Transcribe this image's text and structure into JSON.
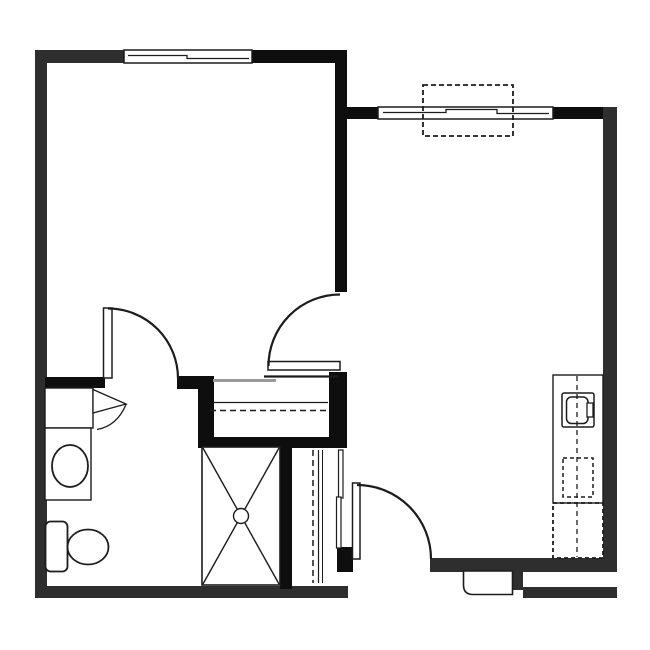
{
  "canvas": {
    "width": 650,
    "height": 650,
    "background": "#ffffff"
  },
  "colors": {
    "wall": "#2e2e2e",
    "wall_dark": "#0e0e0e",
    "line": "#1c1c1c",
    "track": "#9a9a9a",
    "white": "#ffffff"
  },
  "shapes": [
    {
      "type": "rect",
      "name": "top-wall-left",
      "x": 35,
      "y": 50,
      "w": 90,
      "h": 13,
      "fill": "wall"
    },
    {
      "type": "rect",
      "name": "top-wall-mid",
      "x": 252,
      "y": 50,
      "w": 95,
      "h": 13,
      "fill": "wall_dark"
    },
    {
      "type": "rect",
      "name": "left-wall",
      "x": 35,
      "y": 50,
      "w": 12,
      "h": 548,
      "fill": "wall"
    },
    {
      "type": "rect",
      "name": "bottom-wall-left",
      "x": 35,
      "y": 586,
      "w": 313,
      "h": 12,
      "fill": "wall"
    },
    {
      "type": "rect",
      "name": "bedroom-living-wall",
      "x": 335,
      "y": 50,
      "w": 12,
      "h": 242,
      "fill": "wall_dark"
    },
    {
      "type": "rect",
      "name": "living-top-wall-left",
      "x": 347,
      "y": 107,
      "w": 32,
      "h": 12,
      "fill": "wall_dark"
    },
    {
      "type": "rect",
      "name": "living-top-wall-right",
      "x": 552,
      "y": 107,
      "w": 65,
      "h": 12,
      "fill": "wall_dark"
    },
    {
      "type": "rect",
      "name": "right-wall",
      "x": 603,
      "y": 107,
      "w": 14,
      "h": 465,
      "fill": "wall"
    },
    {
      "type": "rect",
      "name": "bottom-wall-right",
      "x": 430,
      "y": 558,
      "w": 187,
      "h": 14,
      "fill": "wall"
    },
    {
      "type": "rect",
      "name": "entry-step-block",
      "x": 511,
      "y": 570,
      "w": 12,
      "h": 20,
      "fill": "wall"
    },
    {
      "type": "rect",
      "name": "bottom-right-lower-wall",
      "x": 523,
      "y": 587,
      "w": 94,
      "h": 11,
      "fill": "wall"
    },
    {
      "type": "rect",
      "name": "vanity-wall-bar",
      "x": 45,
      "y": 377,
      "w": 60,
      "h": 11,
      "fill": "wall_dark"
    },
    {
      "type": "rect",
      "name": "bath-door-jamb-bar",
      "x": 177,
      "y": 376,
      "w": 36,
      "h": 13,
      "fill": "wall_dark"
    },
    {
      "type": "rect",
      "name": "closet-left-wall",
      "x": 198,
      "y": 376,
      "w": 16,
      "h": 68,
      "fill": "wall_dark"
    },
    {
      "type": "rect",
      "name": "closet-bottom-bar",
      "x": 198,
      "y": 437,
      "w": 149,
      "h": 11,
      "fill": "wall_dark"
    },
    {
      "type": "rect",
      "name": "closet-right-wall",
      "x": 329,
      "y": 372,
      "w": 18,
      "h": 70,
      "fill": "wall_dark"
    },
    {
      "type": "rect",
      "name": "shower-partition-wall",
      "x": 280,
      "y": 443,
      "w": 12,
      "h": 146,
      "fill": "wall_dark"
    },
    {
      "type": "rect",
      "name": "entry-door-jamb",
      "x": 337,
      "y": 547,
      "w": 16,
      "h": 25,
      "fill": "wall_dark"
    },
    {
      "type": "rect",
      "name": "bedroom-window",
      "x": 124,
      "y": 50,
      "w": 128,
      "h": 13,
      "fill": "white",
      "stroke": "line",
      "sw": 1.5
    },
    {
      "type": "polyline",
      "name": "bedroom-window-sash",
      "points": "128,55.5 187,55.5 187,58.5 249,58.5",
      "sw": 1.3
    },
    {
      "type": "rect",
      "name": "living-window",
      "x": 378,
      "y": 107,
      "w": 175,
      "h": 12,
      "fill": "white",
      "stroke": "line",
      "sw": 1.5
    },
    {
      "type": "polyline",
      "name": "living-window-sash",
      "points": "383,112.5 446,112.5 446,109.5 497,109.5 497,113.5 549,113.5",
      "sw": 1.3
    },
    {
      "type": "rect",
      "name": "window-seat-dashed-box",
      "x": 423,
      "y": 85,
      "w": 90,
      "h": 51,
      "fill": "none",
      "stroke": "line",
      "sw": 1.8,
      "dash": "5,3"
    },
    {
      "type": "line",
      "name": "closet-bypass-track-dark",
      "x1": 264,
      "y1": 376.5,
      "x2": 338,
      "y2": 376.5,
      "sw": 2.2,
      "stroke": "line"
    },
    {
      "type": "line",
      "name": "closet-bypass-track-gray",
      "x1": 213,
      "y1": 380.5,
      "x2": 276,
      "y2": 380.5,
      "sw": 3,
      "stroke": "track"
    },
    {
      "type": "line",
      "name": "closet-shelf-line",
      "x1": 213,
      "y1": 402.5,
      "x2": 328,
      "y2": 402.5,
      "sw": 1.2,
      "stroke": "line"
    },
    {
      "type": "line",
      "name": "closet-rod-dashed",
      "x1": 210,
      "y1": 410.5,
      "x2": 330,
      "y2": 410.5,
      "sw": 1.5,
      "stroke": "line",
      "dash": "6,4"
    },
    {
      "type": "rect",
      "name": "bedroom-door-leaf",
      "x": 268,
      "y": 361.5,
      "w": 72,
      "h": 8.5,
      "fill": "white",
      "stroke": "line",
      "sw": 1.5
    },
    {
      "type": "path",
      "name": "bedroom-door-arc",
      "d": "M268.5,366 A71.5,71.5 0 0 1 340,294.5",
      "fill": "none",
      "stroke": "line",
      "sw": 2.2
    },
    {
      "type": "rect",
      "name": "bathroom-door-leaf",
      "x": 103.5,
      "y": 308,
      "w": 8.5,
      "h": 70,
      "fill": "white",
      "stroke": "line",
      "sw": 1.5
    },
    {
      "type": "path",
      "name": "bathroom-door-arc",
      "d": "M108,308.5 A70,70 0 0 1 178,378.5",
      "fill": "none",
      "stroke": "line",
      "sw": 2.2
    },
    {
      "type": "rect",
      "name": "vanity-cabinet",
      "x": 45,
      "y": 388,
      "w": 48,
      "h": 40,
      "fill": "white",
      "stroke": "line",
      "sw": 1.4
    },
    {
      "type": "path",
      "name": "vanity-door-wedge",
      "d": "M93,389.5 L126,404 L93,413 Z",
      "fill": "white",
      "stroke": "line",
      "sw": 1.3
    },
    {
      "type": "path",
      "name": "vanity-door-arc",
      "d": "M126,404.5 Q117,426 97,429.5",
      "fill": "none",
      "stroke": "line",
      "sw": 1.3
    },
    {
      "type": "rect",
      "name": "vanity-counter",
      "x": 45,
      "y": 428,
      "w": 46,
      "h": 72,
      "fill": "white",
      "stroke": "line",
      "sw": 1.4
    },
    {
      "type": "ellipse",
      "name": "bathroom-sink-basin",
      "cx": 70,
      "cy": 466,
      "rx": 18,
      "ry": 21,
      "fill": "white",
      "stroke": "line",
      "sw": 1.8
    },
    {
      "type": "rect",
      "name": "toilet-tank",
      "x": 45.5,
      "y": 521.5,
      "w": 22,
      "h": 50,
      "rx": 5,
      "fill": "white",
      "stroke": "line",
      "sw": 1.8
    },
    {
      "type": "ellipse",
      "name": "toilet-bowl",
      "cx": 88,
      "cy": 547,
      "rx": 20.5,
      "ry": 17.5,
      "fill": "white",
      "stroke": "line",
      "sw": 1.8
    },
    {
      "type": "rect",
      "name": "shower-pan",
      "x": 202,
      "y": 447,
      "w": 78,
      "h": 138,
      "fill": "white",
      "stroke": "line",
      "sw": 1.6
    },
    {
      "type": "line",
      "name": "shower-x-line-1",
      "x1": 203,
      "y1": 448,
      "x2": 279,
      "y2": 584,
      "sw": 1.4,
      "stroke": "line"
    },
    {
      "type": "line",
      "name": "shower-x-line-2",
      "x1": 279,
      "y1": 448,
      "x2": 203,
      "y2": 584,
      "sw": 1.4,
      "stroke": "line"
    },
    {
      "type": "circle",
      "name": "shower-drain",
      "cx": 241,
      "cy": 516,
      "r": 7.5,
      "fill": "white",
      "stroke": "line",
      "sw": 1.4
    },
    {
      "type": "line",
      "name": "linen-rod-dashed",
      "x1": 313,
      "y1": 450,
      "x2": 313,
      "y2": 583,
      "sw": 1.5,
      "stroke": "line",
      "dash": "6,4"
    },
    {
      "type": "line",
      "name": "linen-shelf-line-1",
      "x1": 318.5,
      "y1": 450,
      "x2": 318.5,
      "y2": 583,
      "sw": 1.2,
      "stroke": "line"
    },
    {
      "type": "line",
      "name": "linen-shelf-line-2",
      "x1": 322.5,
      "y1": 450,
      "x2": 322.5,
      "y2": 583,
      "sw": 1,
      "stroke": "line"
    },
    {
      "type": "rect",
      "name": "linen-door-panel-a",
      "x": 338.5,
      "y": 450,
      "w": 4.5,
      "h": 48,
      "fill": "white",
      "stroke": "line",
      "sw": 1.2
    },
    {
      "type": "rect",
      "name": "linen-door-panel-b",
      "x": 336.5,
      "y": 497,
      "w": 4.5,
      "h": 51,
      "fill": "white",
      "stroke": "line",
      "sw": 1.2
    },
    {
      "type": "rect",
      "name": "entry-door-leaf",
      "x": 352.5,
      "y": 483,
      "w": 7.5,
      "h": 76,
      "fill": "white",
      "stroke": "line",
      "sw": 1.5
    },
    {
      "type": "path",
      "name": "entry-door-arc",
      "d": "M357,485 A74,74 0 0 1 431,559",
      "fill": "none",
      "stroke": "line",
      "sw": 2.2
    },
    {
      "type": "path",
      "name": "entry-stoop",
      "d": "M463.5,571 L463.5,585 Q463.5,594.5 473,594.5 L512.5,594.5 L512.5,571 Z",
      "fill": "white",
      "stroke": "line",
      "sw": 1.6
    },
    {
      "type": "rect",
      "name": "kitchen-counter",
      "x": 553,
      "y": 375,
      "w": 50,
      "h": 128,
      "fill": "white",
      "stroke": "line",
      "sw": 1.4
    },
    {
      "type": "rect",
      "name": "kitchen-sink-outer",
      "x": 562,
      "y": 393,
      "w": 32,
      "h": 34,
      "rx": 2,
      "fill": "white",
      "stroke": "line",
      "sw": 1.5
    },
    {
      "type": "rect",
      "name": "kitchen-sink-inner",
      "x": 566.5,
      "y": 397,
      "w": 21.5,
      "h": 26.5,
      "rx": 5,
      "fill": "white",
      "stroke": "line",
      "sw": 1.5
    },
    {
      "type": "rect",
      "name": "kitchen-faucet",
      "x": 587,
      "y": 403,
      "w": 6,
      "h": 14,
      "fill": "white",
      "stroke": "line",
      "sw": 1.3
    },
    {
      "type": "rect",
      "name": "dishwasher-dashed",
      "x": 563,
      "y": 458,
      "w": 30,
      "h": 39,
      "fill": "none",
      "stroke": "line",
      "sw": 1.5,
      "dash": "4,3"
    },
    {
      "type": "rect",
      "name": "refrigerator-dashed",
      "x": 553,
      "y": 503,
      "w": 50,
      "h": 55,
      "fill": "none",
      "stroke": "line",
      "sw": 1.8,
      "dash": "4,3"
    },
    {
      "type": "line",
      "name": "kitchen-centerline-dashed",
      "x1": 577,
      "y1": 376,
      "x2": 577,
      "y2": 557,
      "sw": 1.3,
      "stroke": "line",
      "dash": "5,4"
    }
  ]
}
